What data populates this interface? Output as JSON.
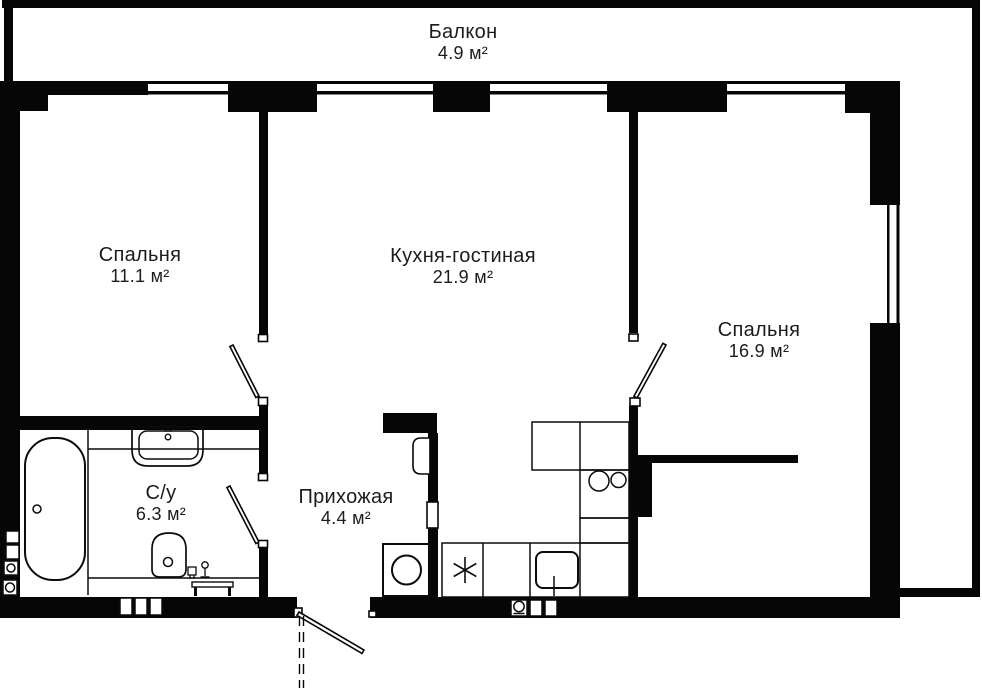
{
  "plan": {
    "colors": {
      "wall": "#060606",
      "background": "#ffffff",
      "text": "#1c1c1c"
    },
    "rooms": [
      {
        "key": "balcony",
        "name": "Балкон",
        "area": "4.9 м²"
      },
      {
        "key": "bedroom1",
        "name": "Спальня",
        "area": "11.1 м²"
      },
      {
        "key": "kitchen",
        "name": "Кухня-гостиная",
        "area": "21.9 м²"
      },
      {
        "key": "bedroom2",
        "name": "Спальня",
        "area": "16.9 м²"
      },
      {
        "key": "bathroom",
        "name": "С/у",
        "area": "6.3 м²"
      },
      {
        "key": "hallway",
        "name": "Прихожая",
        "area": "4.4 м²"
      }
    ]
  }
}
